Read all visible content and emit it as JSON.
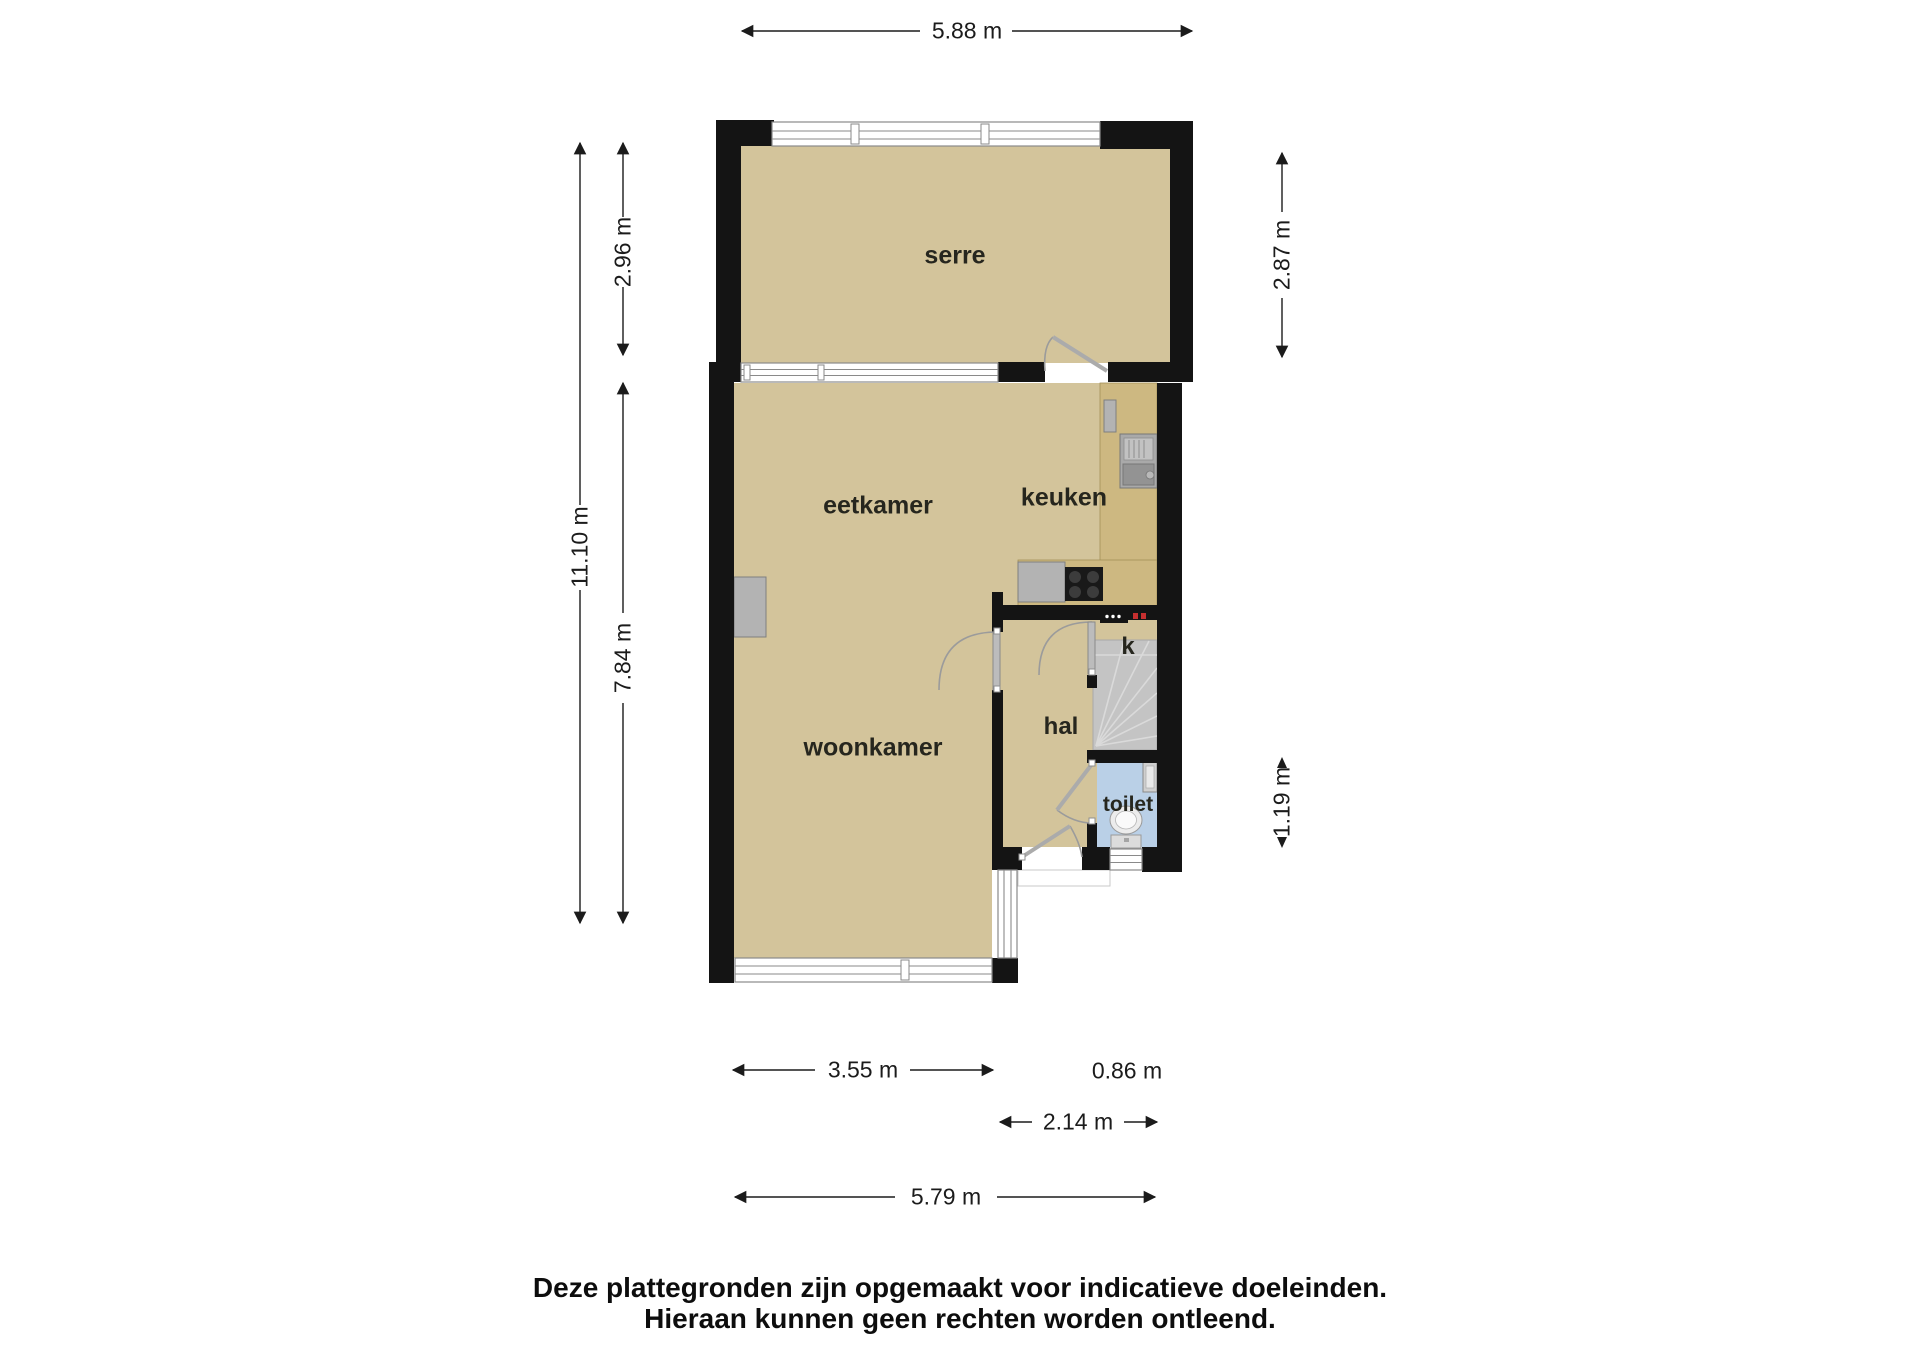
{
  "floorplan": {
    "rooms": [
      {
        "id": "serre",
        "label": "serre"
      },
      {
        "id": "eetkamer",
        "label": "eetkamer"
      },
      {
        "id": "keuken",
        "label": "keuken"
      },
      {
        "id": "woonkamer",
        "label": "woonkamer"
      },
      {
        "id": "hal",
        "label": "hal"
      },
      {
        "id": "kast",
        "label": "k"
      },
      {
        "id": "toilet",
        "label": "toilet"
      }
    ],
    "dimensions": [
      {
        "id": "top-width",
        "label": "5.88 m"
      },
      {
        "id": "left-serre-height",
        "label": "2.96 m"
      },
      {
        "id": "left-total-height",
        "label": "11.10 m"
      },
      {
        "id": "left-lower-height",
        "label": "7.84 m"
      },
      {
        "id": "right-serre-height",
        "label": "2.87 m"
      },
      {
        "id": "right-toilet-height",
        "label": "1.19 m"
      },
      {
        "id": "bottom-woonkamer-width",
        "label": "3.55 m"
      },
      {
        "id": "bottom-offset-width",
        "label": "0.86 m"
      },
      {
        "id": "bottom-hal-width",
        "label": "2.14 m"
      },
      {
        "id": "bottom-total-width",
        "label": "5.79 m"
      }
    ],
    "disclaimer": {
      "line1": "Deze plattegronden zijn opgemaakt voor indicatieve doeleinden.",
      "line2": "Hieraan kunnen geen rechten worden ontleend."
    },
    "colors": {
      "wall": "#141414",
      "floor": "#d3c49b",
      "counter": "#cdb881",
      "stairs": "#c4c4c4",
      "toiletfloor": "#bad0e7",
      "fixture": "#b3b3b3",
      "windowline": "#8a8a8a",
      "dimtext": "#1b1b1b",
      "red": "#c62f2f"
    }
  }
}
